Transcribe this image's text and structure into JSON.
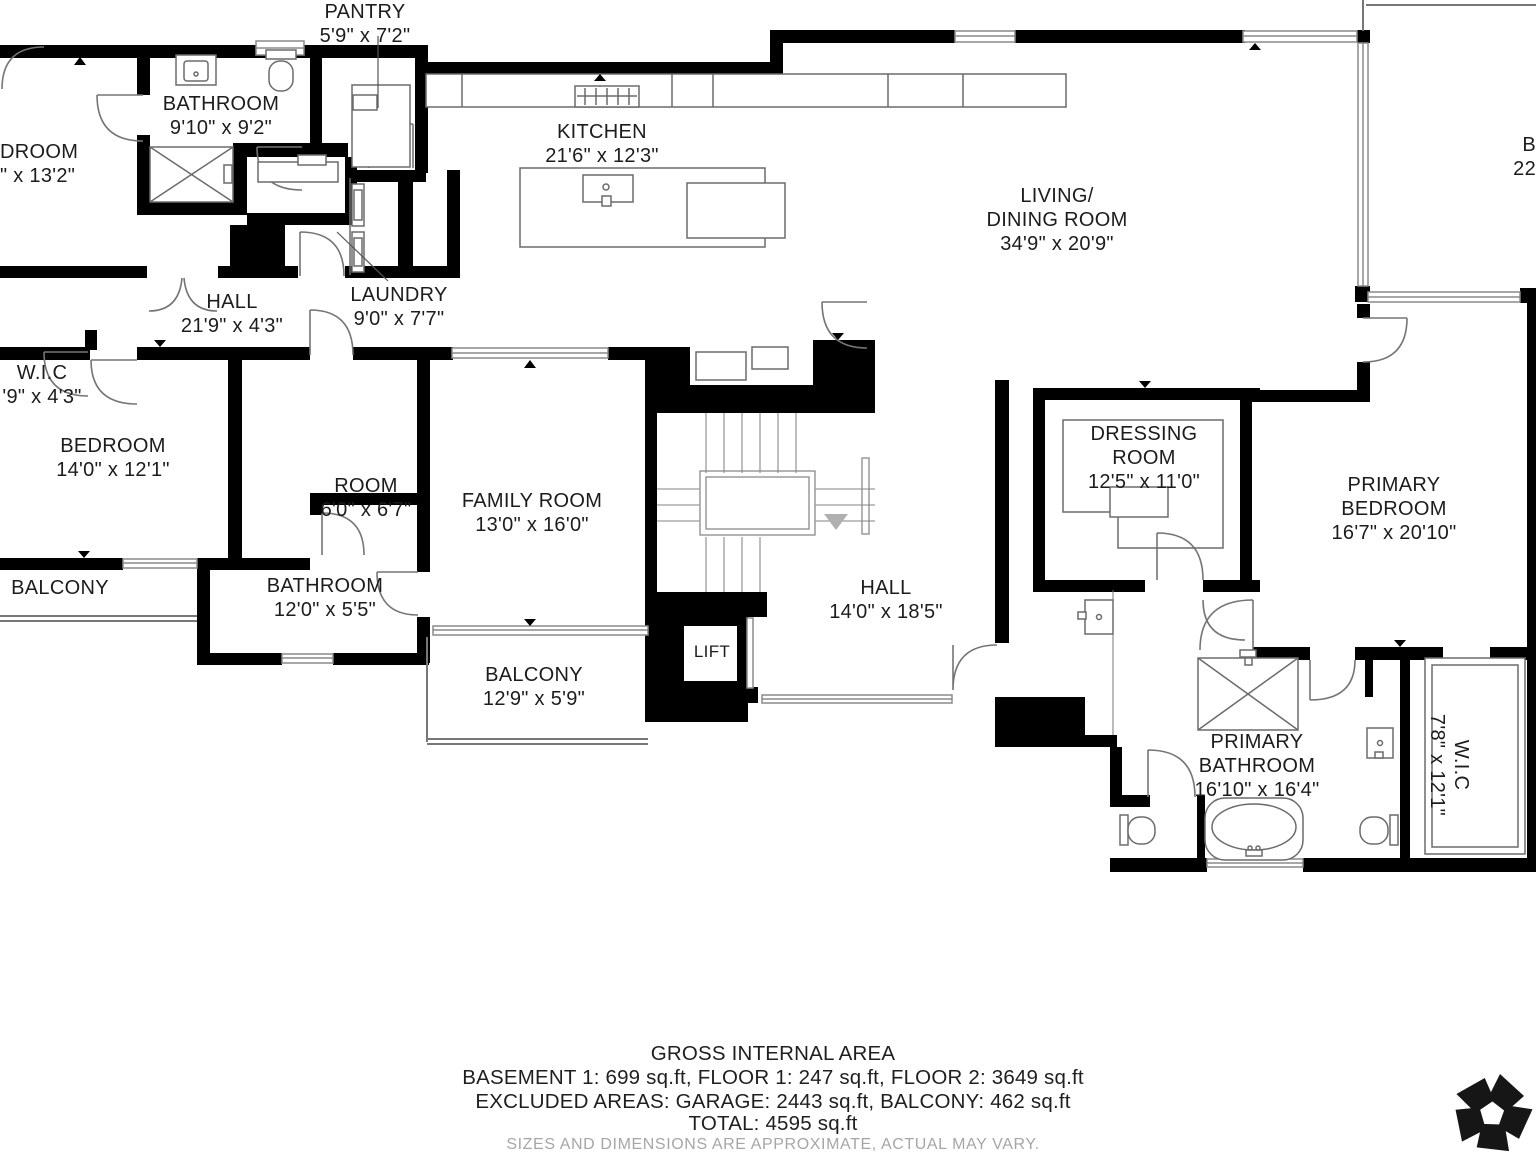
{
  "rooms": {
    "pantry": {
      "name": "PANTRY",
      "dims": "5'9\" x 7'2\""
    },
    "bathroom_top": {
      "name": "BATHROOM",
      "dims": "9'10\" x 9'2\""
    },
    "bedroom_topleft": {
      "name": "DROOM",
      "dims": "\" x 13'2\""
    },
    "kitchen": {
      "name": "KITCHEN",
      "dims": "21'6\" x 12'3\""
    },
    "living": {
      "line1": "LIVING/",
      "line2": "DINING ROOM",
      "dims": "34'9\" x 20'9\""
    },
    "hall_upper": {
      "name": "HALL",
      "dims": "21'9\" x 4'3\""
    },
    "laundry": {
      "name": "LAUNDRY",
      "dims": "9'0\" x 7'7\""
    },
    "wic_left": {
      "name": "W.I.C",
      "dims": "'9\" x 4'3\""
    },
    "bedroom_left": {
      "name": "BEDROOM",
      "dims": "14'0\" x 12'1\""
    },
    "room_small": {
      "name": "ROOM",
      "dims": "6'0\" x 6'7\""
    },
    "family": {
      "name": "FAMILY ROOM",
      "dims": "13'0\" x 16'0\""
    },
    "dressing": {
      "line1": "DRESSING",
      "line2": "ROOM",
      "dims": "12'5\" x 11'0\""
    },
    "primary_bedroom": {
      "line1": "PRIMARY",
      "line2": "BEDROOM",
      "dims": "16'7\" x 20'10\""
    },
    "balcony_left": {
      "name": "BALCONY"
    },
    "bathroom_mid": {
      "name": "BATHROOM",
      "dims": "12'0\" x 5'5\""
    },
    "hall_lower": {
      "name": "HALL",
      "dims": "14'0\" x 18'5\""
    },
    "lift": {
      "name": "LIFT"
    },
    "balcony_lower": {
      "name": "BALCONY",
      "dims": "12'9\" x 5'9\""
    },
    "primary_bathroom": {
      "line1": "PRIMARY",
      "line2": "BATHROOM",
      "dims": "16'10\" x 16'4\""
    },
    "wic_right": {
      "name": "W.I.C",
      "dims": "7'8\" x 12'1\""
    },
    "balcony_right": {
      "line1": "B",
      "line2": "22"
    }
  },
  "footer": {
    "title": "GROSS INTERNAL AREA",
    "line1": "BASEMENT 1: 699 sq.ft, FLOOR 1: 247 sq.ft, FLOOR 2: 3649 sq.ft",
    "line2": "EXCLUDED AREAS: GARAGE: 2443 sq.ft, BALCONY: 462 sq.ft",
    "line3": "TOTAL: 4595 sq.ft",
    "disclaimer": "SIZES AND DIMENSIONS ARE APPROXIMATE, ACTUAL MAY VARY."
  },
  "icons": {
    "logo": "pinwheel-pentagon-logo",
    "stairs_arrow": "down-arrow"
  },
  "colors": {
    "background": "#ffffff",
    "wall": "#000000",
    "window_line": "#8a8a8a",
    "fixture_line": "#6b6b6b",
    "door_line": "#757575",
    "stair_line": "#9c9c9c",
    "label_text": "#1c1c1c",
    "disclaimer_text": "#a6a6a6",
    "logo": "#161616"
  }
}
